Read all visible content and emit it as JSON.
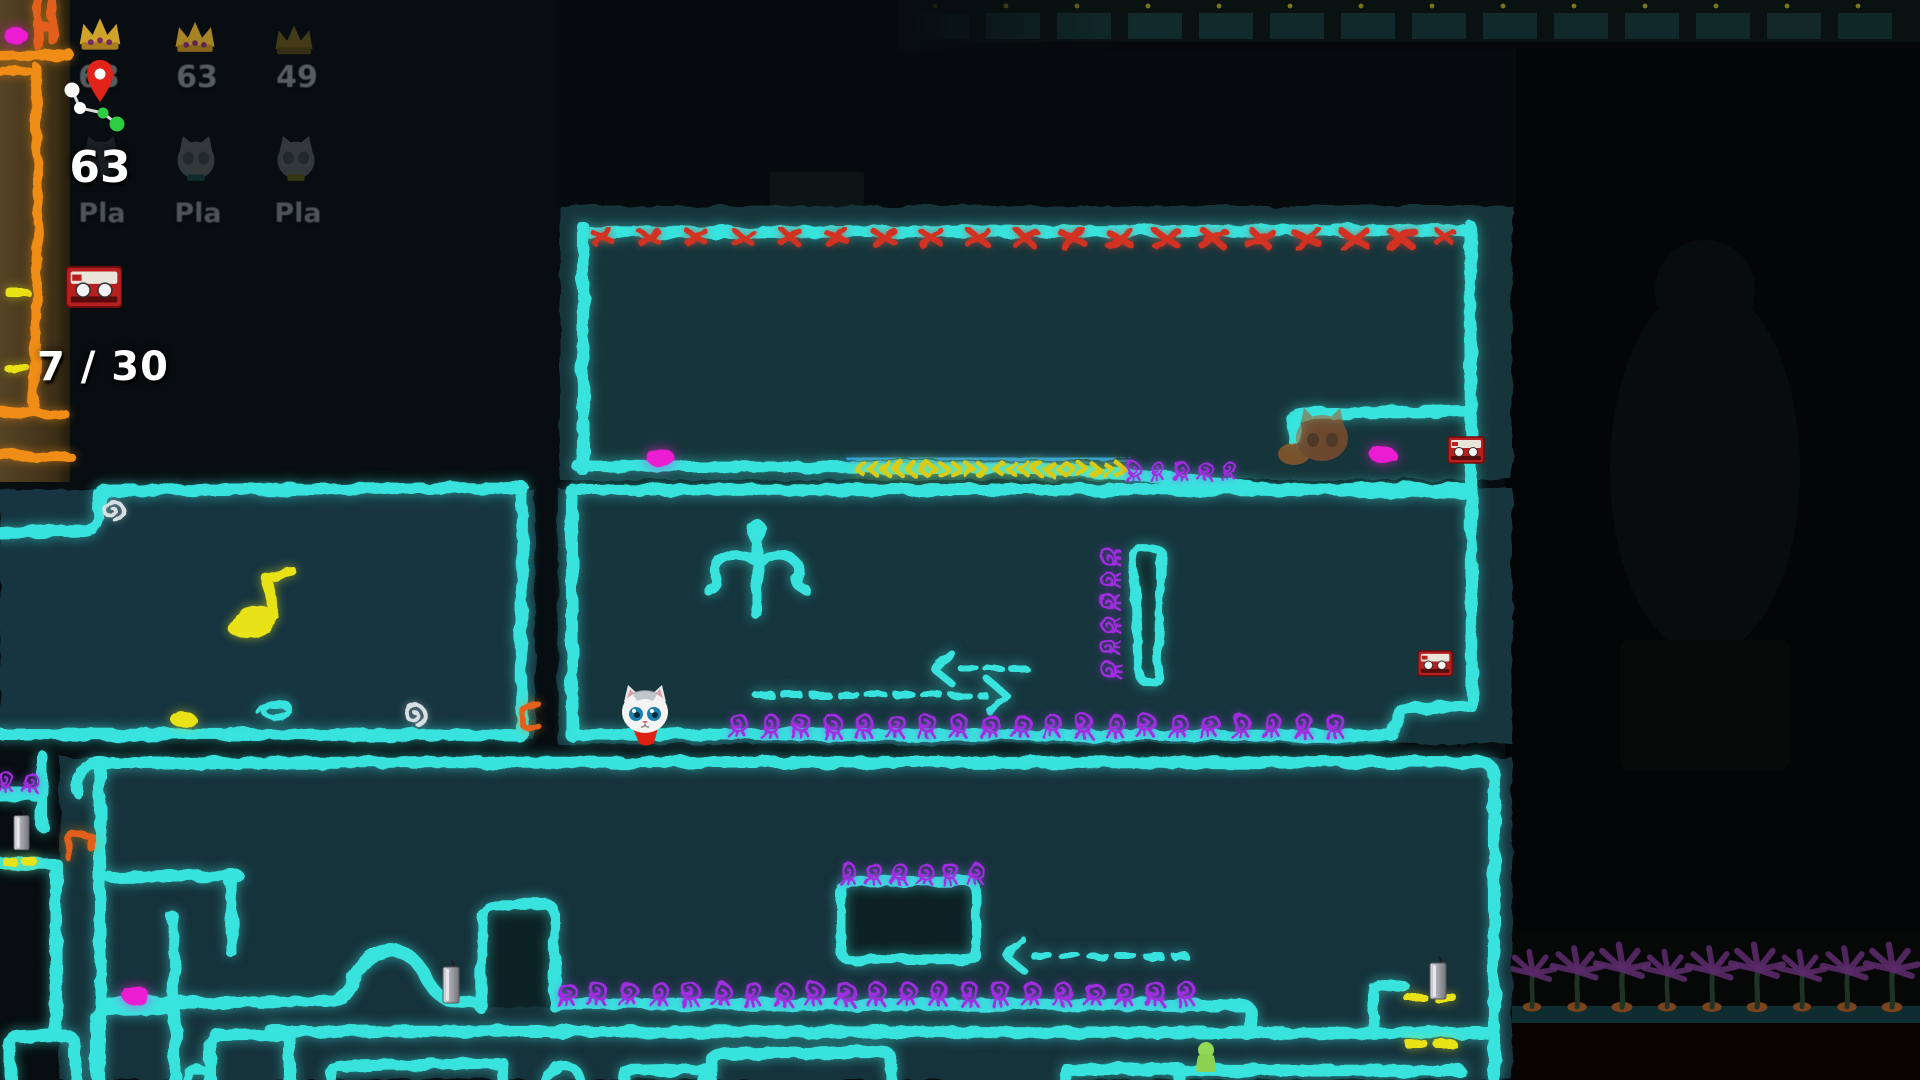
{
  "hud": {
    "leaderboard": [
      {
        "name": "Pla",
        "score": "63"
      },
      {
        "name": "Pla",
        "score": "63"
      },
      {
        "name": "Pla",
        "score": "49"
      }
    ],
    "player_score": "63",
    "tape_counter": "7 / 30"
  },
  "palette": {
    "chalk_cyan": "#3be9e3",
    "room_teal": "#17343b",
    "hazard_red": "#d23222",
    "magenta": "#ec1ed2",
    "chalk_yellow": "#e9e215",
    "creature_purple": "#a02ee0",
    "belt_blue": "#2f9fd8",
    "chalk_orange": "#ef8d12",
    "board_brown": "#4a3a1e",
    "chalk_white": "#d7dfe2",
    "crown_gold": "#cfa22a",
    "palm_purple": "#5a2a68",
    "scarf_red": "#df2012",
    "green_figure": "#93d958"
  },
  "scene": {
    "hazard_x_count": 19,
    "belt_pattern": "LLLLLLRRRRRLLLLLLRRRRR",
    "creatures": {
      "top_room": 5,
      "mid_row": 20,
      "mid_column": 6,
      "bottom_row": 21,
      "platform_row": 6,
      "ledge_pair": 2
    },
    "palm_count": 9,
    "skyline_block_count": 14,
    "collectibles": {
      "magenta_dots": 4,
      "yellow_dots": 1,
      "music_notes": 1,
      "cassette_tapes": 2,
      "candles": 3
    },
    "characters": {
      "player": "white-cat",
      "ghost": "orange-cat",
      "npc": "green-figure"
    }
  }
}
